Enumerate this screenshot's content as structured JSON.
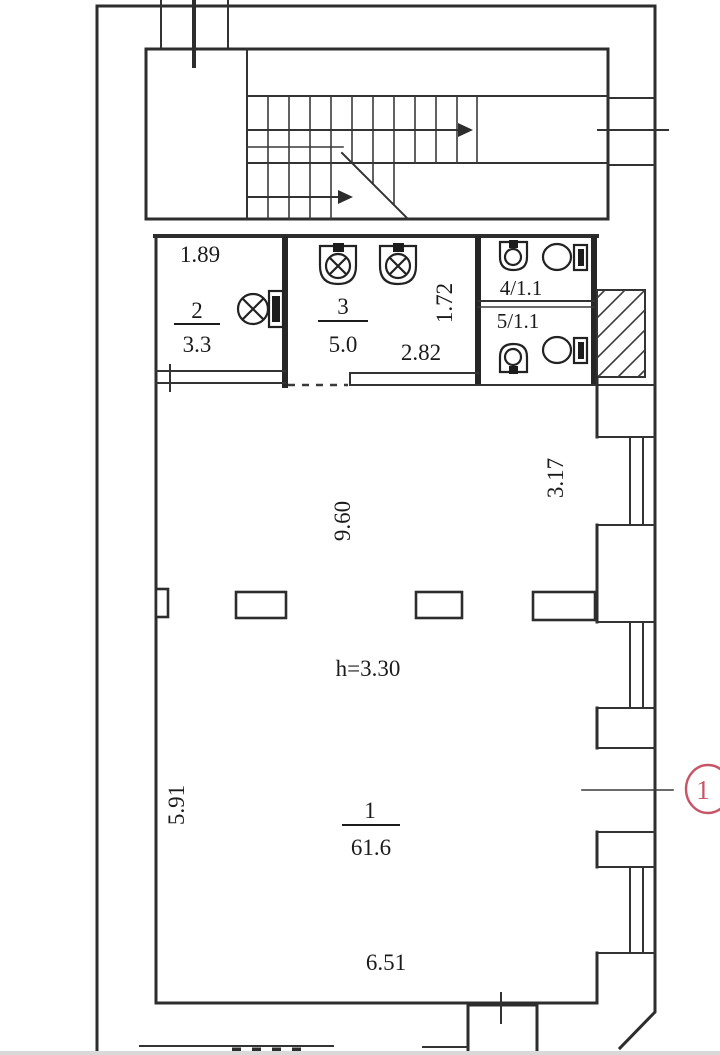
{
  "labels": {
    "dim_189": "1.89",
    "dim_282": "2.82",
    "dim_172": "1.72",
    "dim_960": "9.60",
    "dim_317": "3.17",
    "dim_591": "5.91",
    "dim_651": "6.51",
    "ceiling_height": "h=3.30"
  },
  "rooms": {
    "room1": {
      "number": "1",
      "area": "61.6"
    },
    "room2": {
      "number": "2",
      "area": "3.3"
    },
    "room3": {
      "number": "3",
      "area": "5.0"
    },
    "room4": {
      "label": "4/1.1"
    },
    "room5": {
      "label": "5/1.1"
    }
  },
  "marker": {
    "label": "1",
    "color": "#c65566"
  }
}
